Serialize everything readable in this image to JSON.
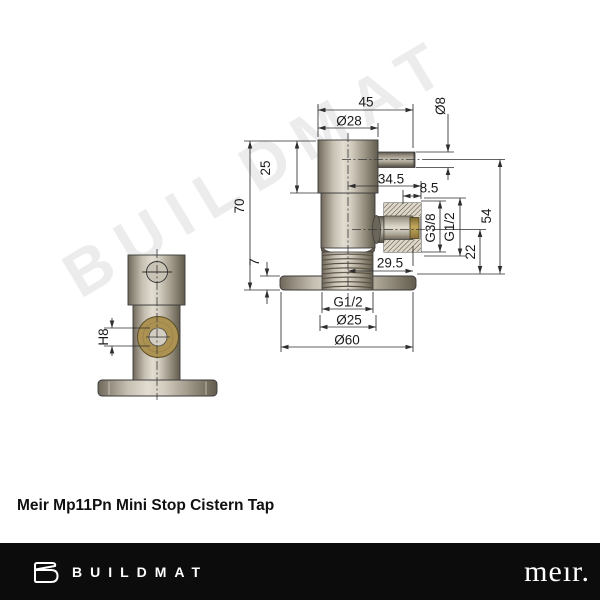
{
  "watermark": "BUILDMAT",
  "title": "Meir Mp11Pn Mini Stop Cistern Tap",
  "drawing": {
    "front_view": {
      "hole_tolerance": "H8"
    },
    "section_view": {
      "overall_width": "45",
      "body_diameter": "Ø28",
      "spigot_diameter": "Ø8",
      "upper_body_height": "25",
      "overall_height": "70",
      "outlet_offset": "34.5",
      "outlet_thread_length": "8.5",
      "outlet_thread_inner": "G3/8",
      "outlet_thread_outer": "G1/2",
      "spigot_centre_height": "54",
      "outlet_centre_height": "22",
      "flange_thickness": "7",
      "outlet_length": "29.5",
      "inlet_thread": "G1/2",
      "inlet_diameter": "Ø25",
      "flange_diameter": "Ø60"
    }
  },
  "footer": {
    "brand": "BUILDMAT",
    "partner_logo": "meır."
  }
}
